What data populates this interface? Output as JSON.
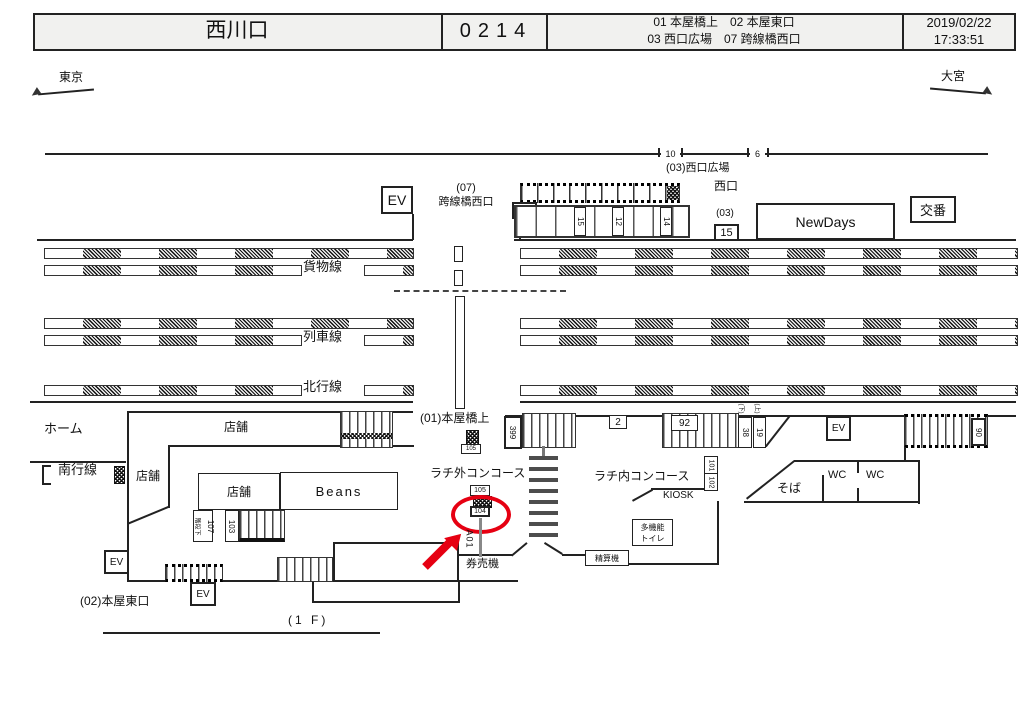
{
  "header": {
    "station": "西川口",
    "code": "0214",
    "loc_line1": "01 本屋橋上　02 本屋東口",
    "loc_line2": "03 西口広場　07 跨線橋西口",
    "date": "2019/02/22",
    "time": "17:33:51"
  },
  "directions": {
    "west": "東京",
    "east": "大宮"
  },
  "plaza": {
    "tick10": "10",
    "tick6": "6",
    "label": "(03)西口広場",
    "west_exit": "西口"
  },
  "building": {
    "ev": "EV",
    "overpass1": "(07)",
    "overpass2": "跨線橋西口",
    "b17": "17",
    "b15v": "15",
    "b12v": "12",
    "b14v": "14",
    "b03": "(03)",
    "b15": "15",
    "newdays": "NewDays",
    "koban": "交番"
  },
  "tracks": {
    "freight": "貨物線",
    "train": "列車線",
    "north": "北行線",
    "south": "南行線",
    "home": "ホーム"
  },
  "bridge": {
    "label": "(01)本屋橋上",
    "b105s": "105"
  },
  "concourse": {
    "shop_top": "店舗",
    "shop_left": "店舗",
    "shop_inner": "店舗",
    "beans": "Beans",
    "under_stair": "階段下",
    "b107": "107",
    "b103": "103",
    "ev1": "EV",
    "ev2": "EV",
    "ev3": "EV",
    "east_exit": "(02)本屋東口",
    "floor": "(1 F)"
  },
  "gates": {
    "outside": "ラチ外コンコース",
    "inside": "ラチ内コンコース",
    "kiosk": "KIOSK",
    "ticket": "券売機",
    "fare": "精算機",
    "toilet1": "多機能",
    "toilet2": "トイレ",
    "soba": "そば",
    "wc1": "WC",
    "wc2": "WC"
  },
  "boards": {
    "b399": "399",
    "b2": "2",
    "b92": "92",
    "b38": "38",
    "b19": "19",
    "down": "(下)",
    "up": "(上)",
    "b90": "90",
    "b101": "101",
    "b102": "102",
    "b105": "105",
    "b104": "104",
    "a01": "A01"
  },
  "colors": {
    "red": "#e60012"
  }
}
